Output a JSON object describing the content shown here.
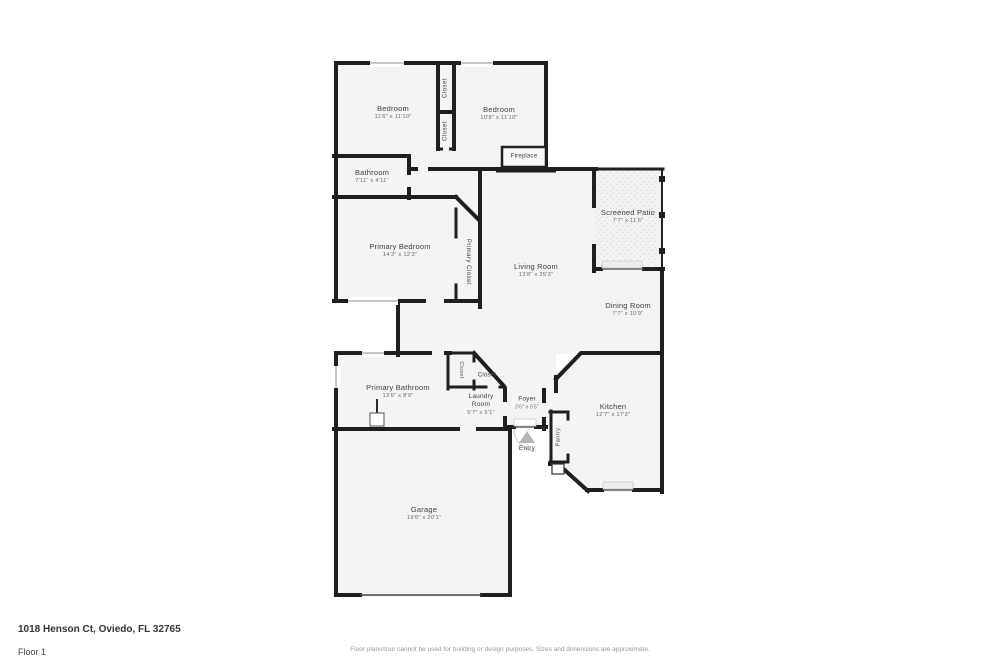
{
  "page": {
    "address": "1018 Henson Ct, Oviedo, FL 32765",
    "floor_label": "Floor 1",
    "disclaimer": "Floor plans/tour cannot be used for building or design purposes. Sizes and dimensions are approximate."
  },
  "rooms": {
    "bedroom_1": {
      "name": "Bedroom",
      "dims": "11'6\" x 11'10\""
    },
    "bedroom_2": {
      "name": "Bedroom",
      "dims": "10'8\" x 11'10\""
    },
    "closet_upper": {
      "name": "Closet"
    },
    "closet_lower": {
      "name": "Closet"
    },
    "fireplace": {
      "name": "Fireplace"
    },
    "bathroom": {
      "name": "Bathroom",
      "dims": "7'11\" x 4'11\""
    },
    "primary_bedroom": {
      "name": "Primary Bedroom",
      "dims": "14'3\" x 12'3\""
    },
    "primary_closet": {
      "name": "Primary Closet"
    },
    "living_room": {
      "name": "Living Room",
      "dims": "13'8\" x 25'3\""
    },
    "screened_patio": {
      "name": "Screened Patio",
      "dims": "7'7\" x 11'6\""
    },
    "dining_room": {
      "name": "Dining Room",
      "dims": "7'7\" x 10'9\""
    },
    "primary_bathroom": {
      "name": "Primary Bathroom",
      "dims": "13'6\" x 8'9\""
    },
    "hall_closet": {
      "name": "Closet"
    },
    "entry_closet": {
      "name": "Closet"
    },
    "laundry_room": {
      "name": "Laundry Room",
      "dims": "5'7\" x 5'1\""
    },
    "foyer": {
      "name": "Foyer",
      "dims": "3'6\" x 5'5\""
    },
    "entry": {
      "name": "Entry"
    },
    "pantry": {
      "name": "Pantry"
    },
    "kitchen": {
      "name": "Kitchen",
      "dims": "12'7\" x 17'3\""
    },
    "garage": {
      "name": "Garage",
      "dims": "19'6\" x 20'1\""
    }
  }
}
